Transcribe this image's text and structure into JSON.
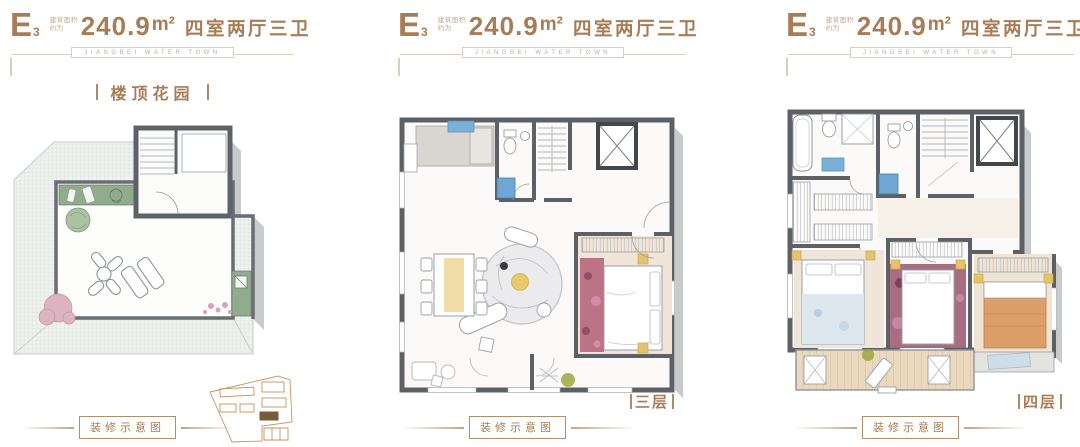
{
  "colors": {
    "accent_brown": "#a87c55",
    "banner_tan": "#c4ac92",
    "wall_dark": "#5d6165",
    "shadow_gray": "#c8cacb",
    "garden_green": "#8fad8c",
    "fixture_blue": "#6fa7d4",
    "bedding_pink": "#b2647a",
    "bedding_orange": "#dc9f69",
    "accent_yellow": "#e3c46a",
    "sitemap_orange": "#c9935f"
  },
  "unit_header": {
    "type_main": "E",
    "type_sub": "3",
    "area_note_line1": "建筑面积",
    "area_note_line2": "约为",
    "area_value": "240.9",
    "area_unit": "m²",
    "layout_text": "四室两厅三卫"
  },
  "brand_banner": "JIANGBEI WATER TOWN",
  "footer_label": "装修示意图",
  "panels": [
    {
      "name": "rooftop",
      "plan_label": "楼顶花园"
    },
    {
      "name": "floor-3",
      "plan_label": "三层"
    },
    {
      "name": "floor-4",
      "plan_label": "四层"
    }
  ]
}
